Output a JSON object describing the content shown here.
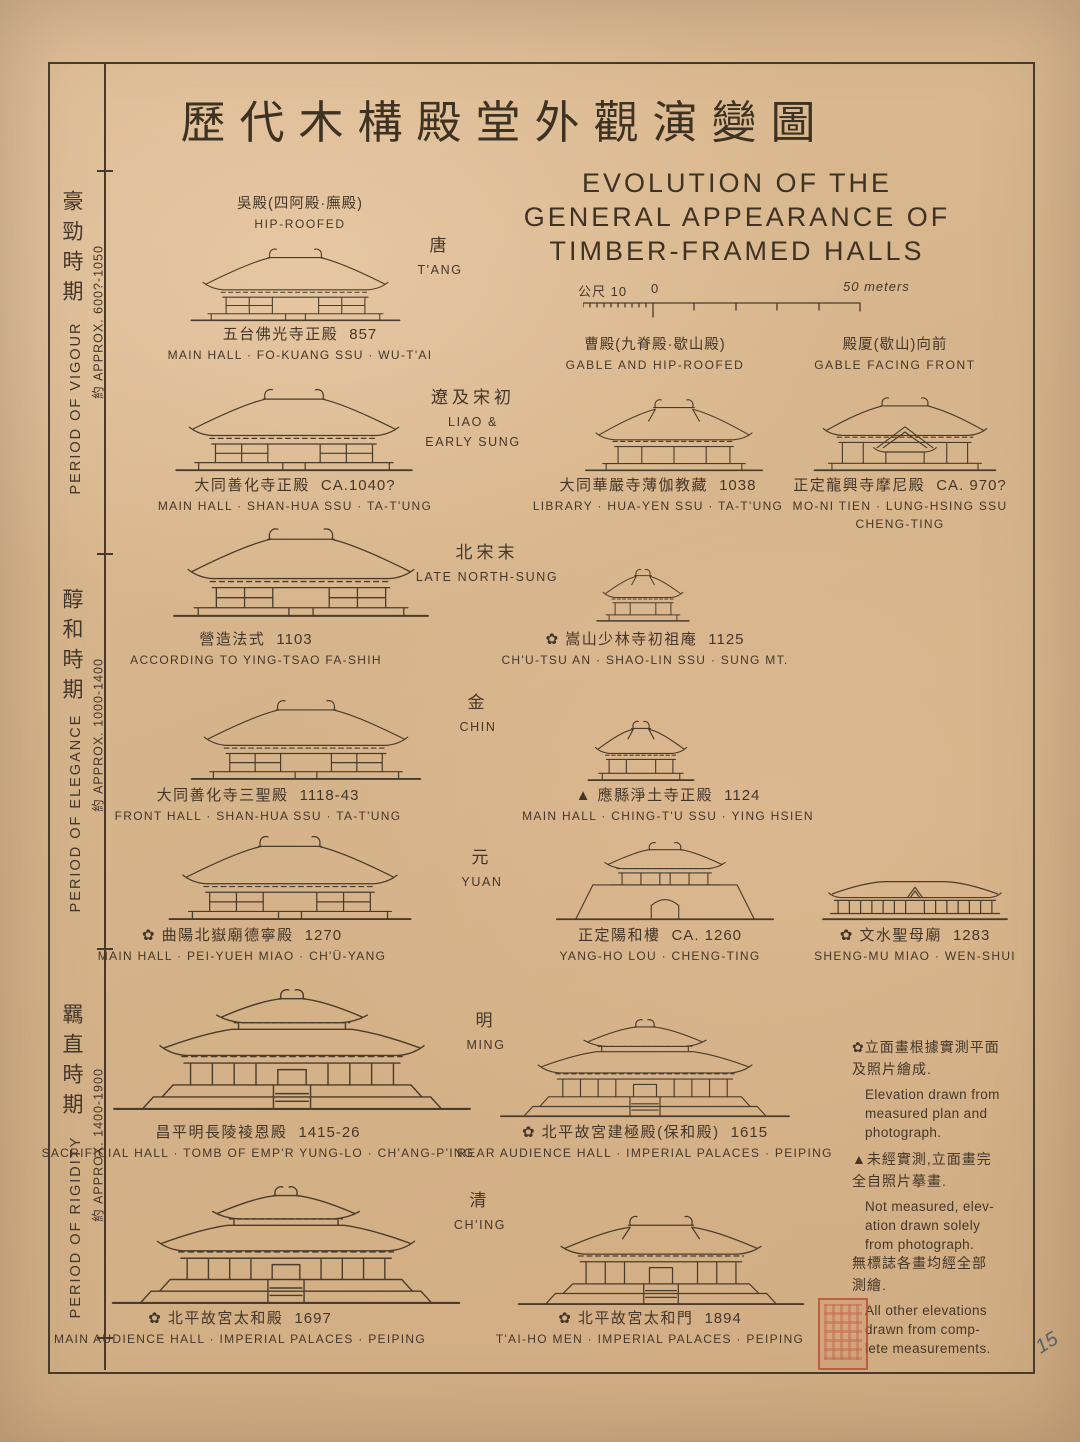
{
  "colors": {
    "paper": "#d8b58c",
    "ink": "#44372a",
    "seal_red": "#ba4a30"
  },
  "title": {
    "zh": "歷代木構殿堂外觀演變圖",
    "en": [
      "EVOLUTION OF THE",
      "GENERAL APPEARANCE OF",
      "TIMBER-FRAMED HALLS"
    ]
  },
  "scale_bar": {
    "left": "公尺 10",
    "zero": "0",
    "right": "50 meters"
  },
  "periods": [
    {
      "zh": "豪勁時期",
      "en": "PERIOD OF VIGOUR",
      "approx": "約 APPROX. 600?-1050"
    },
    {
      "zh": "醇和時期",
      "en": "PERIOD OF ELEGANCE",
      "approx": "約 APPROX. 1000-1400"
    },
    {
      "zh": "羈直時期",
      "en": "PERIOD OF RIGIDITY",
      "approx": "約 APPROX. 1400-1900"
    }
  ],
  "roof_types": [
    {
      "zh": "吳殿(四阿殿·廡殿)",
      "en": "HIP-ROOFED"
    },
    {
      "zh": "曹殿(九脊殿·歇山殿)",
      "en": "GABLE AND HIP-ROOFED"
    },
    {
      "zh": "殿厦(歇山)向前",
      "en": "GABLE FACING FRONT"
    }
  ],
  "eras": [
    {
      "zh": "唐",
      "en": "T'ANG"
    },
    {
      "zh": "遼及宋初",
      "en": "LIAO & EARLY SUNG"
    },
    {
      "zh": "北宋末",
      "en": "LATE NORTH-SUNG"
    },
    {
      "zh": "金",
      "en": "CHIN"
    },
    {
      "zh": "元",
      "en": "YUAN"
    },
    {
      "zh": "明",
      "en": "MING"
    },
    {
      "zh": "清",
      "en": "CH'ING"
    }
  ],
  "buildings": [
    {
      "zh": "五台佛光寺正殿",
      "date": "857",
      "en": [
        "MAIN HALL · FO-KUANG SSU · WU-T'AI"
      ]
    },
    {
      "zh": "大同善化寺正殿",
      "date": "CA.1040?",
      "en": [
        "MAIN HALL · SHAN-HUA SSU · TA-T'UNG"
      ]
    },
    {
      "zh": "大同華嚴寺薄伽教藏",
      "date": "1038",
      "en": [
        "LIBRARY · HUA-YEN SSU · TA-T'UNG"
      ]
    },
    {
      "zh": "正定龍興寺摩尼殿",
      "date": "CA. 970?",
      "en": [
        "MO-NI TIEN · LUNG-HSING SSU",
        "CHENG-TING"
      ]
    },
    {
      "zh": "營造法式",
      "date": "1103",
      "en": [
        "ACCORDING TO YING-TSAO FA-SHIH"
      ]
    },
    {
      "zh": "✿ 嵩山少林寺初祖庵",
      "date": "1125",
      "en": [
        "CH'U-TSU AN · SHAO-LIN SSU · SUNG MT."
      ]
    },
    {
      "zh": "大同善化寺三聖殿",
      "date": "1118-43",
      "en": [
        "FRONT HALL · SHAN-HUA SSU · TA-T'UNG"
      ]
    },
    {
      "zh": "▲ 應縣淨土寺正殿",
      "date": "1124",
      "en": [
        "MAIN HALL · CHING-T'U SSU · YING HSIEN"
      ]
    },
    {
      "zh": "✿ 曲陽北嶽廟德寧殿",
      "date": "1270",
      "en": [
        "MAIN HALL · PEI-YUEH MIAO · CH'Ü-YANG"
      ]
    },
    {
      "zh": "正定陽和樓",
      "date": "CA. 1260",
      "en": [
        "YANG-HO LOU · CHENG-TING"
      ]
    },
    {
      "zh": "✿ 文水聖母廟",
      "date": "1283",
      "en": [
        "SHENG-MU MIAO · WEN-SHUI"
      ]
    },
    {
      "zh": "昌平明長陵祾恩殿",
      "date": "1415-26",
      "en": [
        "SACRIFICIAL HALL · TOMB OF EMP'R YUNG-LO · CH'ANG-P'ING"
      ]
    },
    {
      "zh": "✿ 北平故宮建極殿(保和殿)",
      "date": "1615",
      "en": [
        "REAR AUDIENCE HALL · IMPERIAL PALACES · PEIPING"
      ]
    },
    {
      "zh": "✿ 北平故宮太和殿",
      "date": "1697",
      "en": [
        "MAIN AUDIENCE HALL · IMPERIAL PALACES · PEIPING"
      ]
    },
    {
      "zh": "✿ 北平故宮太和門",
      "date": "1894",
      "en": [
        "T'AI-HO MEN · IMPERIAL PALACES · PEIPING"
      ]
    }
  ],
  "notes": [
    {
      "zh": [
        "✿立面畫根據實測平面",
        "及照片繪成."
      ],
      "en": [
        "Elevation drawn from",
        "measured plan and",
        "photograph."
      ]
    },
    {
      "zh": [
        "▲未經實測,立面畫完",
        "全自照片摹畫."
      ],
      "en": [
        "Not measured, elev-",
        "ation drawn solely",
        "from photograph."
      ]
    },
    {
      "zh": [
        "無標誌各畫均經全部",
        "測繪."
      ],
      "en": [
        "All other elevations",
        "drawn from comp-",
        "lete measurements."
      ]
    }
  ],
  "page_number": "15"
}
